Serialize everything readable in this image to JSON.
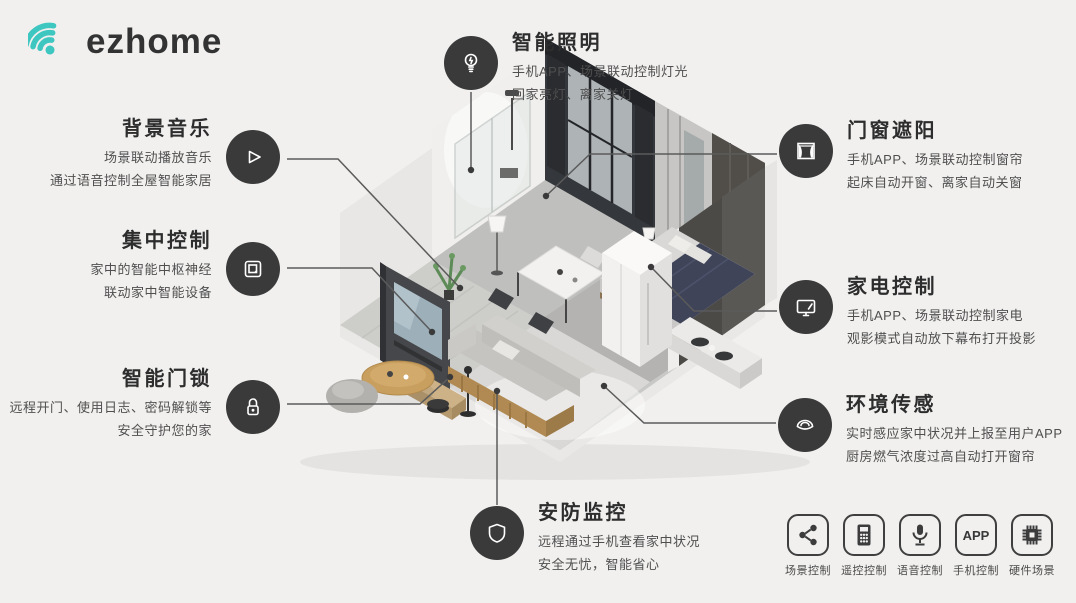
{
  "logo": {
    "text": "ezhome",
    "accent_color": "#3ec6c0"
  },
  "features": [
    {
      "id": "smart-lighting",
      "title": "智能照明",
      "line1": "手机APP、场景联动控制灯光",
      "line2": "回家亮灯、离家关灯",
      "icon": "bulb-icon"
    },
    {
      "id": "background-music",
      "title": "背景音乐",
      "line1": "场景联动播放音乐",
      "line2": "通过语音控制全屋智能家居",
      "icon": "play-icon"
    },
    {
      "id": "central-control",
      "title": "集中控制",
      "line1": "家中的智能中枢神经",
      "line2": "联动家中智能设备",
      "icon": "control-panel-icon"
    },
    {
      "id": "smart-door-lock",
      "title": "智能门锁",
      "line1": "远程开门、使用日志、密码解锁等",
      "line2": "安全守护您的家",
      "icon": "lock-icon"
    },
    {
      "id": "window-shading",
      "title": "门窗遮阳",
      "line1": "手机APP、场景联动控制窗帘",
      "line2": "起床自动开窗、离家自动关窗",
      "icon": "curtain-icon"
    },
    {
      "id": "appliance-control",
      "title": "家电控制",
      "line1": "手机APP、场景联动控制家电",
      "line2": "观影模式自动放下幕布打开投影",
      "icon": "tv-icon"
    },
    {
      "id": "environment-sensing",
      "title": "环境传感",
      "line1": "实时感应家中状况并上报至用户APP",
      "line2": "厨房燃气浓度过高自动打开窗帘",
      "icon": "sensor-icon"
    },
    {
      "id": "security-monitoring",
      "title": "安防监控",
      "line1": "远程通过手机查看家中状况",
      "line2": "安全无忧，智能省心",
      "icon": "shield-icon"
    }
  ],
  "control_modes": [
    {
      "label": "场景控制",
      "icon": "share-icon"
    },
    {
      "label": "遥控控制",
      "icon": "remote-icon"
    },
    {
      "label": "语音控制",
      "icon": "mic-icon"
    },
    {
      "label": "手机控制",
      "icon": "app-icon",
      "icon_text": "APP"
    },
    {
      "label": "硬件场景",
      "icon": "chip-icon"
    }
  ],
  "colors": {
    "background": "#f1f0ef",
    "accent_teal": "#3ec6c0",
    "icon_circle": "#3a3a3a",
    "title_text": "#2d2d2d",
    "body_text": "#4f4f4f",
    "connector_line": "#5b5b5b"
  }
}
